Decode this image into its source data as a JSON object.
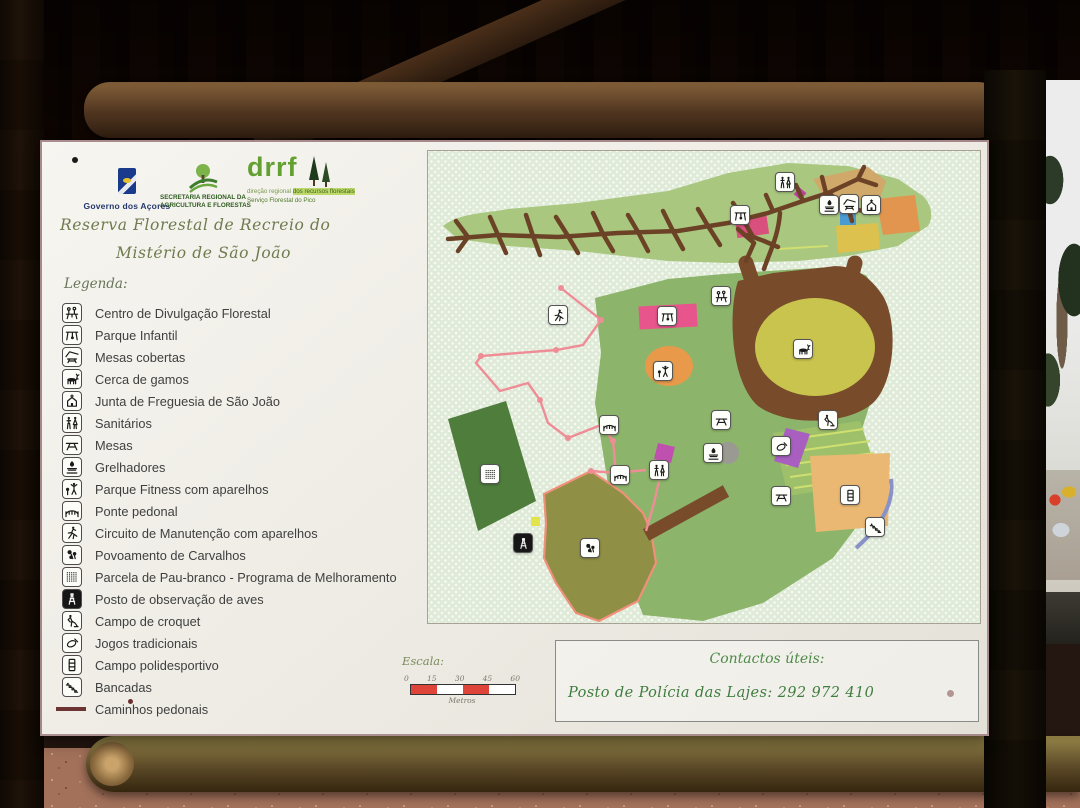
{
  "panel": {
    "logos": {
      "governo_label": "Governo dos Açores",
      "secretaria_line1": "SECRETARIA REGIONAL DA",
      "secretaria_line2": "AGRICULTURA E FLORESTAS",
      "drrf_acronym": "drrf",
      "drrf_line1": "direção regional",
      "drrf_line2": "dos recursos florestais",
      "drrf_line3": "Serviço Florestal do Pico"
    },
    "title": {
      "line1": "Reserva Florestal de Recreio do",
      "line2": "Mistério de São João"
    },
    "legend": {
      "heading": "Legenda:",
      "items": [
        {
          "icon": "centro",
          "label": "Centro de Divulgação Florestal"
        },
        {
          "icon": "swing",
          "label": "Parque Infantil"
        },
        {
          "icon": "covered-table",
          "label": "Mesas cobertas"
        },
        {
          "icon": "deer",
          "label": "Cerca de gamos"
        },
        {
          "icon": "church",
          "label": "Junta de Freguesia de São João"
        },
        {
          "icon": "wc",
          "label": "Sanitários"
        },
        {
          "icon": "picnic-table",
          "label": "Mesas"
        },
        {
          "icon": "grill",
          "label": "Grelhadores"
        },
        {
          "icon": "fitness",
          "label": "Parque Fitness com aparelhos"
        },
        {
          "icon": "bridge",
          "label": "Ponte pedonal"
        },
        {
          "icon": "runner",
          "label": "Circuito de Manutenção com aparelhos"
        },
        {
          "icon": "leaves",
          "label": "Povoamento de Carvalhos"
        },
        {
          "icon": "grid",
          "label": "Parcela de Pau-branco - Programa de Melhoramento"
        },
        {
          "icon": "tower",
          "label": "Posto de observação de aves",
          "inverted": true
        },
        {
          "icon": "croquet",
          "label": "Campo de croquet"
        },
        {
          "icon": "quoits",
          "label": "Jogos tradicionais"
        },
        {
          "icon": "field",
          "label": "Campo polidesportivo"
        },
        {
          "icon": "bleachers",
          "label": "Bancadas"
        },
        {
          "icon": "path-line",
          "label": "Caminhos pedonais",
          "swatch": true
        }
      ]
    },
    "scale": {
      "heading": "Escala:",
      "ticks": [
        "0",
        "15",
        "30",
        "45",
        "60"
      ],
      "unit": "Metros",
      "filled_color": "#df4438",
      "empty_color": "#ffffff"
    },
    "contacts": {
      "heading": "Contactos úteis:",
      "line": "Posto de Polícia das Lajes: 292 972 410"
    }
  },
  "map": {
    "colors": {
      "stipple_base": "#dfead9",
      "band_green": "#a9c77f",
      "central_green": "#8cb56b",
      "parcela_dark_green": "#4e7d3c",
      "carvalhos_olive": "#8f8f45",
      "deer_ring_brown": "#784b2b",
      "deer_inner_yellow": "#c9c44e",
      "trail_brown": "#6b4226",
      "fitness_trail_pink": "#ef8d96",
      "playground_pink": "#e8548c",
      "orange": "#e89a4a",
      "sports_field_orange": "#eab873",
      "purple": "#a85fc0",
      "blue": "#4a9ad4"
    },
    "markers": [
      {
        "icon": "wc",
        "x": 357,
        "y": 31
      },
      {
        "icon": "swing",
        "x": 312,
        "y": 64
      },
      {
        "icon": "grill",
        "x": 401,
        "y": 54
      },
      {
        "icon": "covered-table",
        "x": 421,
        "y": 53
      },
      {
        "icon": "church",
        "x": 443,
        "y": 54
      },
      {
        "icon": "centro",
        "x": 293,
        "y": 145
      },
      {
        "icon": "runner",
        "x": 130,
        "y": 164
      },
      {
        "icon": "swing",
        "x": 239,
        "y": 165
      },
      {
        "icon": "fitness",
        "x": 235,
        "y": 220
      },
      {
        "icon": "deer",
        "x": 375,
        "y": 198
      },
      {
        "icon": "picnic-table",
        "x": 293,
        "y": 269
      },
      {
        "icon": "bridge",
        "x": 181,
        "y": 274
      },
      {
        "icon": "croquet",
        "x": 400,
        "y": 269
      },
      {
        "icon": "grill",
        "x": 285,
        "y": 302
      },
      {
        "icon": "quoits",
        "x": 353,
        "y": 295
      },
      {
        "icon": "wc",
        "x": 231,
        "y": 319
      },
      {
        "icon": "bridge",
        "x": 192,
        "y": 324
      },
      {
        "icon": "picnic-table",
        "x": 353,
        "y": 345
      },
      {
        "icon": "field",
        "x": 422,
        "y": 344
      },
      {
        "icon": "bleachers",
        "x": 447,
        "y": 376
      },
      {
        "icon": "grid",
        "x": 62,
        "y": 323
      },
      {
        "icon": "tower",
        "x": 95,
        "y": 392,
        "inverted": true
      },
      {
        "icon": "leaves",
        "x": 162,
        "y": 397
      }
    ]
  }
}
